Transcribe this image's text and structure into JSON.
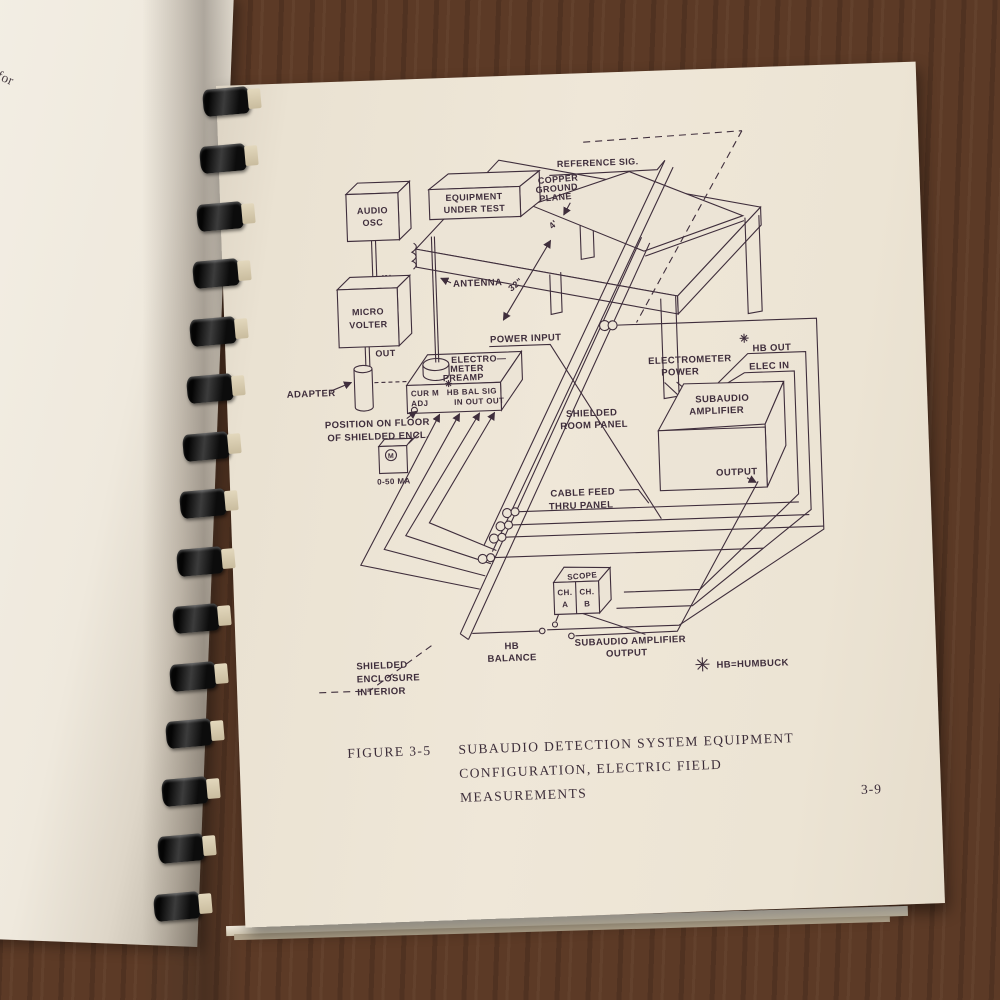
{
  "colors": {
    "ink": "#3f2e3c",
    "paper": "#ece4d6",
    "paper_left": "#f0ebe1",
    "wood": "#5d3b27"
  },
  "left_page": {
    "fragments": [
      "re 3-4)",
      "Post Connectors for",
      "ration.",
      "Post Connectors for",
      "ring calibration.",
      "rom Calibrate Adapter",
      "iven in Figure 3-5 for",
      "1A/SA and ET-1A/E.  Refer",
      "arrangement for magnetic",
      "nd ET-1A/SML.",
      "ECK",
      "re should be followed",
      "up and operating",
      "nnected as in Figure",
      "to the ELECTRIC",
      "Maximum CCW)",
      "t to channel A of",
      "in its place the",
      "icrovolter, apply",
      "apter input.  A",
      "d now appear on",
      "k on the electrical",
      "The MDS (Minimum",
      "n 40 db above 1 µv.",
      "ck the sensitivity",
      "ows:"
    ]
  },
  "right_page": {
    "diagram": {
      "audio_osc": [
        "AUDIO",
        "OSC"
      ],
      "in_label": "IN",
      "microvolter": [
        "MICRO",
        "VOLTER"
      ],
      "out_label": "OUT",
      "adapter": "ADAPTER",
      "antenna": "ANTENNA",
      "equipment_under_test": [
        "EQUIPMENT",
        "UNDER  TEST"
      ],
      "reference_sig": "REFERENCE  SIG.",
      "copper_ground_plane": [
        "COPPER",
        "GROUND",
        "PLANE"
      ],
      "dim_4ft": "4'",
      "dim_32in": "32\"",
      "power_input": "POWER INPUT",
      "electrometer_preamp": [
        "ELECTRO—",
        "METER",
        "PREAMP"
      ],
      "preamp_panel": {
        "row1_left": "CUR M",
        "row2_left": "ADJ",
        "row1_right": "HB BAL SIG",
        "row2_right": "IN OUT OUT",
        "asterisk_icon": "eight-point-asterisk"
      },
      "position_on_floor": [
        "POSITION ON FLOOR",
        "OF SHIELDED ENCL."
      ],
      "meter_m": "M",
      "meter_range": "0-50 MA",
      "shielded_room_panel": [
        "SHIELDED",
        "ROOM PANEL"
      ],
      "cable_feed": [
        "CABLE FEED",
        "THRU PANEL"
      ],
      "electrometer_power": [
        "ELECTROMETER",
        "POWER"
      ],
      "hb_out": "HB OUT",
      "elec_in": "ELEC IN",
      "subaudio_amplifier": [
        "SUBAUDIO",
        "AMPLIFIER"
      ],
      "output": "OUTPUT",
      "scope": "SCOPE",
      "ch_a": [
        "CH.",
        "A"
      ],
      "ch_b": [
        "CH.",
        "B"
      ],
      "hb_balance": [
        "HB",
        "BALANCE"
      ],
      "subaudio_amp_output": [
        "SUBAUDIO AMPLIFIER",
        "OUTPUT"
      ],
      "humbuck_note": "HB=HUMBUCK",
      "humbuck_symbol_icon": "eight-point-asterisk",
      "shielded_enclosure": [
        "SHIELDED",
        "ENCLOSURE",
        "INTERIOR"
      ]
    },
    "caption": {
      "figure_no": "FIGURE 3-5",
      "lines": [
        "SUBAUDIO DETECTION SYSTEM EQUIPMENT",
        "CONFIGURATION, ELECTRIC FIELD",
        "MEASUREMENTS"
      ]
    },
    "page_number": "3-9"
  }
}
